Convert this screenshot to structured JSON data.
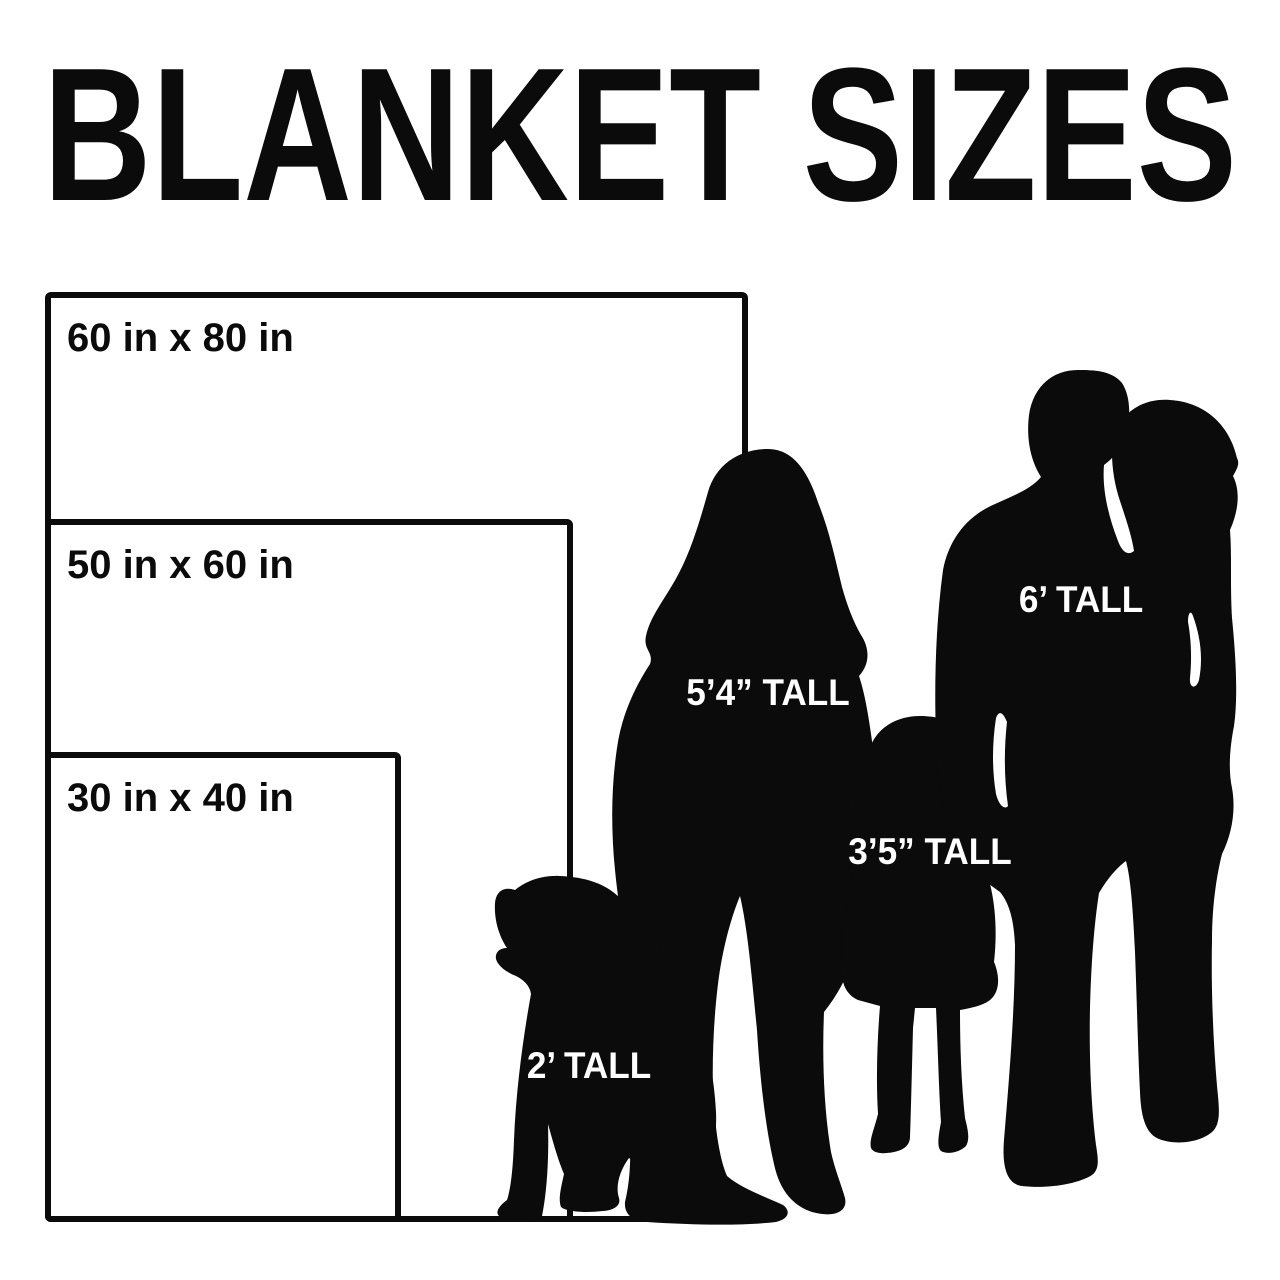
{
  "title": "BLANKET SIZES",
  "colors": {
    "ink": "#0b0b0b",
    "background": "#ffffff",
    "figure_label_text": "#ffffff"
  },
  "blankets": [
    {
      "label": "60 in x 80 in",
      "width_in": 60,
      "height_in": 80
    },
    {
      "label": "50 in x 60 in",
      "width_in": 50,
      "height_in": 60
    },
    {
      "label": "30 in x 40 in",
      "width_in": 30,
      "height_in": 40
    }
  ],
  "figures": [
    {
      "name": "adult-woman",
      "label": "5’4” TALL"
    },
    {
      "name": "man-carrying-toddler",
      "label": "6’ TALL"
    },
    {
      "name": "child-girl",
      "label": "3’5” TALL"
    },
    {
      "name": "dog",
      "label": "2’ TALL"
    }
  ]
}
